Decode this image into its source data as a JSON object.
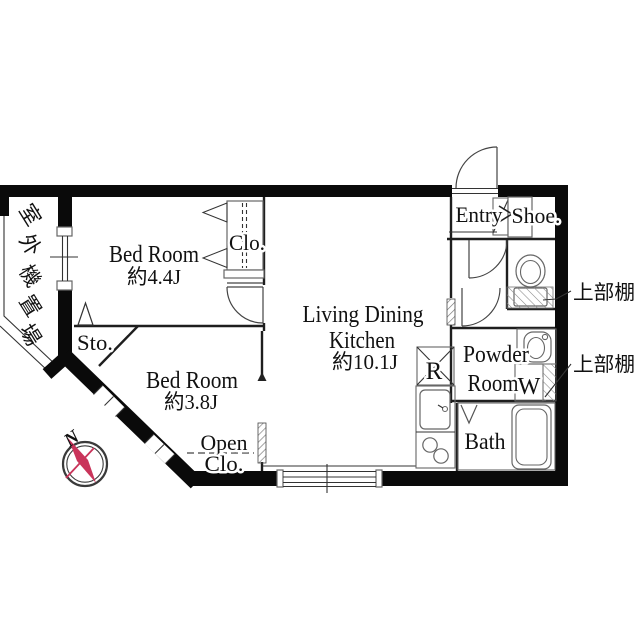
{
  "floor_plan": {
    "rooms": {
      "bedroom_1": {
        "name": "Bed Room",
        "area": "約4.4J"
      },
      "bedroom_2": {
        "name": "Bed Room",
        "area": "約3.8J"
      },
      "living_dining_kitchen": {
        "name_line1": "Living Dining",
        "name_line2": "Kitchen",
        "area": "約10.1J"
      },
      "powder_room": {
        "name_line1": "Powder",
        "name_line2": "Room"
      },
      "bath": {
        "name": "Bath"
      },
      "entry": {
        "name": "Entry"
      }
    },
    "features": {
      "closet": "Clo.",
      "storage": "Sto.",
      "open_closet_line1": "Open",
      "open_closet_line2": "Clo.",
      "shoe_cabinet": "Shoe.",
      "refrigerator_space": "R",
      "washing_machine": "W",
      "upper_shelf_toilet": "上部棚",
      "upper_shelf_laundry": "上部棚",
      "outdoor_unit_space": "室外機置場",
      "outdoor_unit_chars": [
        "室",
        "外",
        "機",
        "置",
        "場"
      ]
    },
    "compass": {
      "north": "N"
    },
    "colors": {
      "wall": "#0a0a0a",
      "thin_line": "#1e1e1e",
      "fixture_line": "#666666",
      "compass_red": "#c9345a",
      "text": "#111111",
      "background": "#ffffff"
    }
  }
}
